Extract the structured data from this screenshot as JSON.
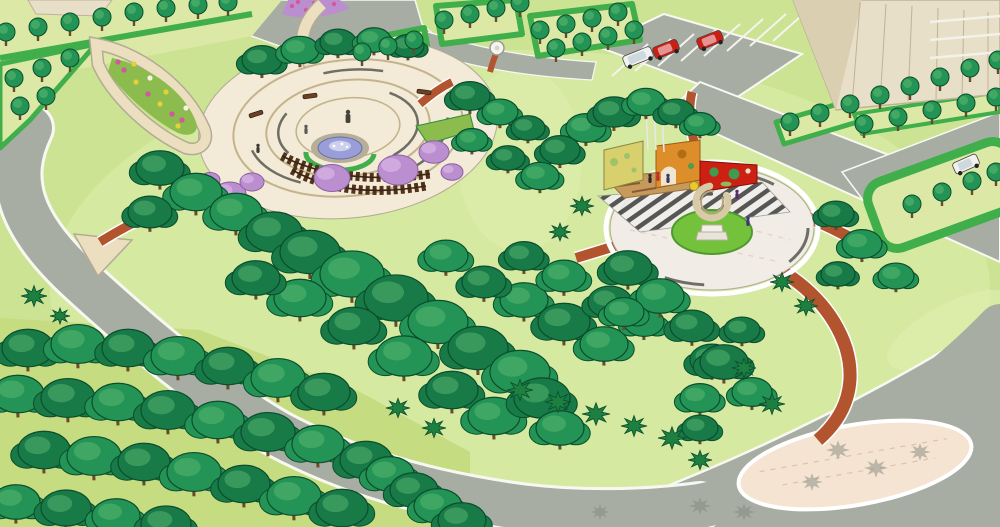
{
  "meta": {
    "caption": "Aerial 3D landscape rendering of an elliptical neighborhood park with a circular fountain plaza, a pergola, a sculpture plaza with colorful art walls, winding brick paths, perimeter roads, street-tree hedges, a parking lot with cars, and high-rise buildings at the corners."
  },
  "scene": {
    "type": "3d-park-landscape-rendering",
    "palette": {
      "lawn": "#cde394",
      "lawn_light": "#ddeeab",
      "shrubland": "#c6dc80",
      "strip_lawn": "#dcе9a6x",
      "striplawn": "#dce9a6",
      "road": "#a8ada4",
      "curb": "#f8f8f2",
      "shadow": "#82887e",
      "canopy_dark": "#177a47",
      "canopy": "#239455",
      "canopy_mid": "#2fa863",
      "canopy_hl": "#5cb871",
      "canopy_line": "#0b4d2c",
      "hedge": "#3fae4b",
      "hedge_dark": "#2c8f3a",
      "shrub": "#1d8040",
      "trunk": "#6b4a2a",
      "path_cream": "#ecdfc0",
      "path_edge": "#b2ab95",
      "brick": "#b2552f",
      "brick_light": "#c97a4e",
      "plaza": "#f3ead7",
      "plaza2": "#f1ece6",
      "ring": "#c4b48c",
      "ring_dark": "#6e6e64",
      "lens": "#f4e4d1",
      "water": "#9a9ed8",
      "water_light": "#cdd0ec",
      "stone": "#b6ae97",
      "pergola": "#523219",
      "wall_yellow": "#d8cf6d",
      "wall_orange": "#dd8d2a",
      "wall_red": "#cc2013",
      "sand": "#c59a5c",
      "log": "#8a5a30",
      "building": "#e8dfc8",
      "building_dark": "#dbcfb2",
      "building_line": "#bfb296",
      "car_red": "#cc1f14",
      "car_white": "#f1f1ef",
      "blossom": "#bb8ecf",
      "blossom_light": "#d4aee2",
      "flower_pink": "#d0589e",
      "flower_yellow": "#e5cf3a",
      "flower_white": "#f2f2e8",
      "bed_green": "#8cbb4e",
      "bed_bright": "#74c23c",
      "sculpt": "#d8c9a7",
      "sculpt_dark": "#b3a37d",
      "stripe_dark": "#4e4e4e"
    },
    "inventory": {
      "plazas": [
        "circular fountain plaza with concentric paving and wooden pergola",
        "circular sculpture plaza with ring sculpture and three art walls (yellow, orange, red)"
      ],
      "paths": [
        "red brick trails",
        "cream stone walks"
      ],
      "vehicles": [
        "white van",
        "red car",
        "red car",
        "white car"
      ],
      "vegetation": [
        "canopy trees",
        "street trees in hedge strips",
        "spiky shrubs",
        "purple blossom trees",
        "flower beds"
      ],
      "buildings": [
        "tan high-rise top-right",
        "building sliver top-left"
      ]
    },
    "trees": {
      "canopy_back": [
        [
          262,
          60,
          20,
          0
        ],
        [
          300,
          50,
          19,
          1
        ],
        [
          338,
          42,
          18,
          0
        ],
        [
          374,
          40,
          17,
          1
        ],
        [
          408,
          46,
          16,
          0
        ],
        [
          586,
          128,
          20,
          1
        ],
        [
          614,
          112,
          21,
          0
        ],
        [
          646,
          102,
          19,
          1
        ],
        [
          676,
          112,
          18,
          0
        ],
        [
          700,
          124,
          16,
          1
        ],
        [
          560,
          150,
          20,
          0
        ],
        [
          470,
          96,
          20,
          0
        ],
        [
          500,
          112,
          18,
          1
        ],
        [
          528,
          128,
          17,
          0
        ],
        [
          472,
          140,
          16,
          1
        ],
        [
          508,
          158,
          17,
          0
        ],
        [
          540,
          176,
          19,
          1
        ]
      ],
      "canopy_front": [
        [
          160,
          168,
          24,
          0
        ],
        [
          196,
          192,
          26,
          1
        ],
        [
          150,
          212,
          22,
          0
        ],
        [
          236,
          212,
          26,
          1
        ],
        [
          274,
          232,
          28,
          0
        ],
        [
          310,
          252,
          30,
          0
        ],
        [
          352,
          274,
          32,
          1
        ],
        [
          396,
          298,
          32,
          0
        ],
        [
          300,
          298,
          26,
          1
        ],
        [
          256,
          278,
          24,
          0
        ],
        [
          438,
          322,
          30,
          1
        ],
        [
          478,
          348,
          30,
          0
        ],
        [
          520,
          372,
          30,
          1
        ],
        [
          354,
          326,
          26,
          0
        ],
        [
          404,
          356,
          28,
          1
        ],
        [
          452,
          390,
          26,
          0
        ],
        [
          494,
          416,
          26,
          1
        ],
        [
          542,
          398,
          28,
          0
        ],
        [
          560,
          428,
          24,
          1
        ],
        [
          524,
          300,
          24,
          1
        ],
        [
          564,
          322,
          26,
          0
        ],
        [
          604,
          344,
          24,
          1
        ],
        [
          484,
          282,
          22,
          0
        ],
        [
          446,
          256,
          22,
          1
        ],
        [
          524,
          256,
          20,
          0
        ],
        [
          564,
          276,
          22,
          1
        ],
        [
          610,
          302,
          22,
          0
        ],
        [
          644,
          322,
          20,
          1
        ],
        [
          628,
          268,
          24,
          0
        ],
        [
          660,
          296,
          24,
          1
        ],
        [
          692,
          326,
          22,
          0
        ],
        [
          624,
          312,
          20,
          1
        ],
        [
          712,
          360,
          22,
          0
        ],
        [
          700,
          398,
          20,
          1
        ],
        [
          742,
          330,
          18,
          0
        ],
        [
          836,
          214,
          18,
          0
        ],
        [
          862,
          244,
          20,
          1
        ],
        [
          838,
          274,
          17,
          0
        ],
        [
          896,
          276,
          18,
          1
        ],
        [
          724,
          362,
          24,
          0
        ],
        [
          752,
          392,
          20,
          1
        ],
        [
          700,
          428,
          18,
          0
        ],
        [
          28,
          348,
          26,
          0
        ],
        [
          78,
          344,
          27,
          1
        ],
        [
          128,
          348,
          26,
          0
        ],
        [
          178,
          356,
          27,
          1
        ],
        [
          228,
          366,
          26,
          0
        ],
        [
          278,
          378,
          27,
          1
        ],
        [
          324,
          392,
          26,
          0
        ],
        [
          18,
          394,
          26,
          1
        ],
        [
          68,
          398,
          27,
          0
        ],
        [
          118,
          402,
          26,
          1
        ],
        [
          168,
          410,
          27,
          0
        ],
        [
          218,
          420,
          26,
          1
        ],
        [
          268,
          432,
          27,
          0
        ],
        [
          318,
          444,
          26,
          1
        ],
        [
          366,
          460,
          26,
          0
        ],
        [
          44,
          450,
          26,
          0
        ],
        [
          94,
          456,
          27,
          1
        ],
        [
          144,
          462,
          26,
          0
        ],
        [
          194,
          472,
          27,
          1
        ],
        [
          244,
          484,
          26,
          0
        ],
        [
          294,
          496,
          27,
          1
        ],
        [
          342,
          508,
          26,
          0
        ],
        [
          390,
          474,
          24,
          1
        ],
        [
          414,
          490,
          24,
          0
        ],
        [
          438,
          506,
          24,
          1
        ],
        [
          16,
          502,
          24,
          1
        ],
        [
          66,
          508,
          25,
          0
        ],
        [
          116,
          516,
          24,
          1
        ],
        [
          166,
          524,
          25,
          0
        ],
        [
          462,
          520,
          24,
          0
        ]
      ],
      "street": [
        [
          6,
          32
        ],
        [
          38,
          27
        ],
        [
          70,
          22
        ],
        [
          102,
          17
        ],
        [
          134,
          12
        ],
        [
          166,
          8
        ],
        [
          198,
          5
        ],
        [
          228,
          2
        ],
        [
          14,
          78
        ],
        [
          42,
          68
        ],
        [
          70,
          58
        ],
        [
          20,
          106
        ],
        [
          46,
          96
        ],
        [
          362,
          52
        ],
        [
          388,
          46
        ],
        [
          414,
          40
        ],
        [
          444,
          20
        ],
        [
          470,
          14
        ],
        [
          496,
          8
        ],
        [
          520,
          3
        ],
        [
          540,
          30
        ],
        [
          566,
          24
        ],
        [
          592,
          18
        ],
        [
          618,
          12
        ],
        [
          556,
          48
        ],
        [
          582,
          42
        ],
        [
          608,
          36
        ],
        [
          634,
          30
        ],
        [
          790,
          122
        ],
        [
          820,
          113
        ],
        [
          850,
          104
        ],
        [
          880,
          95
        ],
        [
          910,
          86
        ],
        [
          940,
          77
        ],
        [
          970,
          68
        ],
        [
          998,
          60
        ],
        [
          864,
          124
        ],
        [
          898,
          117
        ],
        [
          932,
          110
        ],
        [
          966,
          103
        ],
        [
          996,
          97
        ],
        [
          912,
          204
        ],
        [
          942,
          192
        ],
        [
          972,
          181
        ],
        [
          996,
          172
        ]
      ],
      "shrubs": [
        [
          520,
          390,
          13,
          0
        ],
        [
          558,
          402,
          13,
          0
        ],
        [
          596,
          414,
          14,
          0
        ],
        [
          634,
          426,
          13,
          0
        ],
        [
          672,
          438,
          14,
          0
        ],
        [
          434,
          428,
          12,
          0
        ],
        [
          398,
          408,
          12,
          0
        ],
        [
          582,
          206,
          12,
          0
        ],
        [
          560,
          232,
          11,
          0
        ],
        [
          782,
          282,
          12,
          0
        ],
        [
          806,
          306,
          12,
          0
        ],
        [
          744,
          368,
          12,
          0
        ],
        [
          772,
          404,
          13,
          0
        ],
        [
          700,
          460,
          12,
          0
        ],
        [
          34,
          296,
          13,
          0
        ],
        [
          60,
          316,
          10,
          0
        ],
        [
          838,
          450,
          12,
          1
        ],
        [
          876,
          468,
          12,
          1
        ],
        [
          812,
          482,
          11,
          1
        ],
        [
          920,
          452,
          11,
          1
        ],
        [
          700,
          506,
          11,
          1
        ],
        [
          744,
          512,
          11,
          1
        ],
        [
          600,
          512,
          10,
          1
        ]
      ],
      "blossoms": [
        [
          230,
          194,
          16
        ],
        [
          252,
          182,
          12
        ],
        [
          332,
          178,
          18
        ],
        [
          398,
          170,
          20
        ],
        [
          434,
          152,
          15
        ],
        [
          452,
          172,
          11
        ],
        [
          210,
          180,
          10
        ]
      ]
    },
    "flowers": {
      "teardrop_bed": [
        [
          124,
          70,
          "flower_pink"
        ],
        [
          136,
          82,
          "flower_yellow"
        ],
        [
          148,
          94,
          "flower_pink"
        ],
        [
          160,
          104,
          "flower_yellow"
        ],
        [
          172,
          114,
          "flower_pink"
        ],
        [
          150,
          78,
          "flower_white"
        ],
        [
          166,
          92,
          "flower_yellow"
        ],
        [
          182,
          120,
          "flower_pink"
        ],
        [
          134,
          64,
          "flower_yellow"
        ],
        [
          186,
          108,
          "flower_white"
        ],
        [
          118,
          62,
          "flower_pink"
        ],
        [
          178,
          126,
          "flower_yellow"
        ]
      ],
      "pink_bed": [
        [
          292,
          6
        ],
        [
          306,
          10
        ],
        [
          320,
          8
        ],
        [
          334,
          4
        ],
        [
          298,
          2
        ],
        [
          314,
          3
        ]
      ]
    },
    "parking_stalls": [
      [
        612,
        76,
        648,
        44
      ],
      [
        635,
        71,
        671,
        39
      ],
      [
        658,
        66,
        694,
        34
      ],
      [
        681,
        61,
        717,
        29
      ],
      [
        704,
        56,
        740,
        24
      ],
      [
        727,
        51,
        763,
        19
      ],
      [
        750,
        46,
        786,
        14
      ],
      [
        773,
        41,
        809,
        9
      ]
    ],
    "cars": [
      {
        "x": 638,
        "y": 57,
        "rot": -22,
        "color": "white",
        "van": true
      },
      {
        "x": 666,
        "y": 49,
        "rot": -22,
        "color": "red",
        "van": false
      },
      {
        "x": 710,
        "y": 40,
        "rot": -22,
        "color": "red",
        "van": false
      },
      {
        "x": 966,
        "y": 164,
        "rot": -24,
        "color": "white",
        "van": false
      }
    ],
    "people": [
      {
        "x": 306,
        "y": 131,
        "c": "#5a5a52"
      },
      {
        "x": 258,
        "y": 150,
        "c": "#3c3c34"
      },
      {
        "x": 658,
        "y": 178,
        "c": "#c03028"
      },
      {
        "x": 668,
        "y": 180,
        "c": "#343a6a"
      },
      {
        "x": 650,
        "y": 180,
        "c": "#2a2a2a"
      },
      {
        "x": 737,
        "y": 196,
        "c": "#5a2a6a"
      },
      {
        "x": 748,
        "y": 223,
        "c": "#44307a"
      }
    ]
  }
}
